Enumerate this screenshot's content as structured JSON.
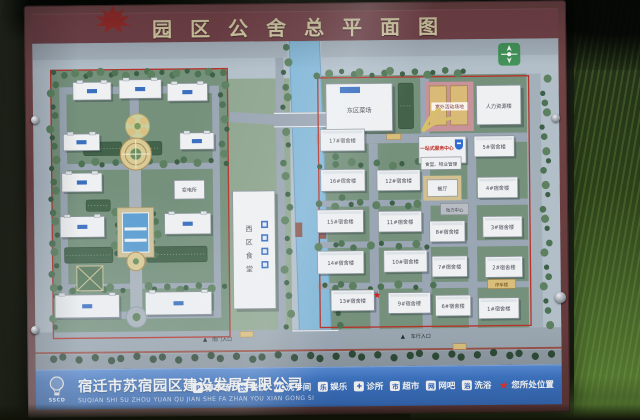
{
  "board": {
    "title": "园区公舍总平面图"
  },
  "map": {
    "north_arrow": "north",
    "west": {
      "canteen_label": "西区食堂",
      "substation_label": "变电所",
      "south_gate_label": "南门入口"
    },
    "east": {
      "market_label": "东区菜场",
      "activity_label": "室外活动场地",
      "hr_label": "人力资源楼",
      "service_center_label": "一站式服务中心",
      "canteen_mgmt_label": "食堂、物业管理",
      "restaurant_label": "餐厅",
      "power_label": "动力中心",
      "parking_label": "停车楼",
      "east_gate_label": "车行入口"
    },
    "dormitories": [
      {
        "label": "17#宿舍楼",
        "x": 322,
        "y": 138,
        "w": 44,
        "h": 21
      },
      {
        "label": "16#宿舍楼",
        "x": 322,
        "y": 177,
        "w": 44,
        "h": 21
      },
      {
        "label": "15#宿舍楼",
        "x": 318,
        "y": 216,
        "w": 46,
        "h": 22
      },
      {
        "label": "14#宿舍楼",
        "x": 318,
        "y": 256,
        "w": 46,
        "h": 22
      },
      {
        "label": "13#宿舍楼",
        "x": 331,
        "y": 294,
        "w": 43,
        "h": 20
      },
      {
        "label": "12#宿舍楼",
        "x": 378,
        "y": 178,
        "w": 43,
        "h": 20
      },
      {
        "label": "11#宿舍楼",
        "x": 379,
        "y": 218,
        "w": 43,
        "h": 20
      },
      {
        "label": "10#宿舍楼",
        "x": 384,
        "y": 256,
        "w": 43,
        "h": 21
      },
      {
        "label": "9#宿舍楼",
        "x": 388,
        "y": 297,
        "w": 42,
        "h": 20
      },
      {
        "label": "8#宿舍楼",
        "x": 430,
        "y": 228,
        "w": 35,
        "h": 20
      },
      {
        "label": "7#宿舍楼",
        "x": 432,
        "y": 262,
        "w": 35,
        "h": 20
      },
      {
        "label": "6#宿舍楼",
        "x": 435,
        "y": 300,
        "w": 35,
        "h": 20
      },
      {
        "label": "5#宿舍楼",
        "x": 475,
        "y": 146,
        "w": 40,
        "h": 20
      },
      {
        "label": "4#宿舍楼",
        "x": 478,
        "y": 186,
        "w": 40,
        "h": 20
      },
      {
        "label": "3#宿舍楼",
        "x": 483,
        "y": 224,
        "w": 39,
        "h": 20
      },
      {
        "label": "2#宿舍楼",
        "x": 485,
        "y": 263,
        "w": 37,
        "h": 20
      },
      {
        "label": "1#宿舍楼",
        "x": 478,
        "y": 303,
        "w": 40,
        "h": 20
      }
    ]
  },
  "footer": {
    "logo_text": "SSCD",
    "company": "宿迁市苏宿园区建设发展有限公司",
    "company_pinyin": "SUQIAN SHI SU ZHOU YUAN QU JIAN SHE FA ZHAN YOU XIAN GONG SI",
    "legend": [
      {
        "icon": "parking-icon",
        "glyph": "P",
        "label": "停车场"
      },
      {
        "icon": "dining-icon",
        "glyph": "饮",
        "label": "餐饮"
      },
      {
        "icon": "restroom-icon",
        "glyph": "WC",
        "label": "洗手间"
      },
      {
        "icon": "entertainment-icon",
        "glyph": "乐",
        "label": "娱乐"
      },
      {
        "icon": "clinic-icon",
        "glyph": "✚",
        "label": "诊所"
      },
      {
        "icon": "supermarket-icon",
        "glyph": "市",
        "label": "超市"
      },
      {
        "icon": "internet-cafe-icon",
        "glyph": "网",
        "label": "网吧"
      },
      {
        "icon": "bath-icon",
        "glyph": "浴",
        "label": "洗浴"
      },
      {
        "icon": "you-are-here-star-icon",
        "glyph": "★",
        "label": "您所处位置",
        "star": true
      }
    ]
  },
  "colors": {
    "frame_maroon": "#6e4245",
    "footer_blue": "#3f77c6",
    "map_green": "#75917c",
    "river_blue": "#84b8d8",
    "boundary_red": "#b5332b",
    "star_red": "#d42a20"
  }
}
